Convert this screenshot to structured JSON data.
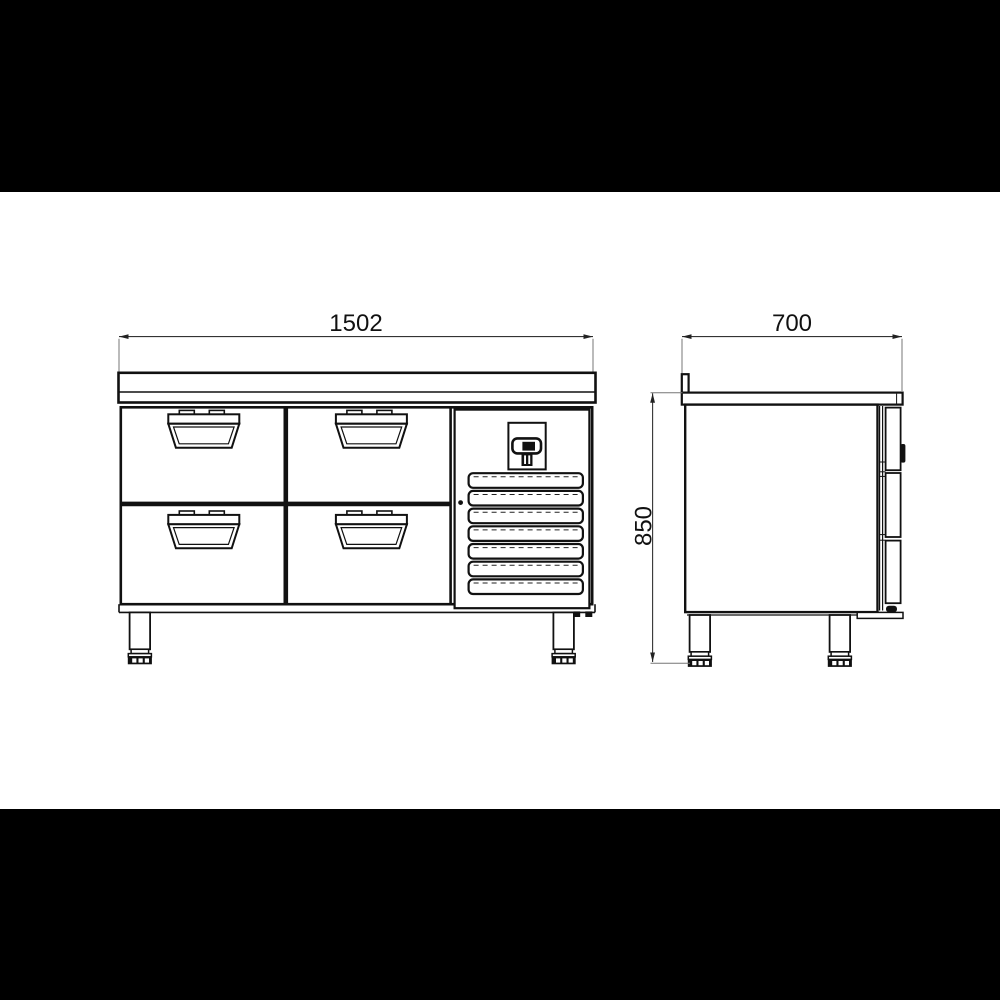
{
  "drawing": {
    "dimension_labels": {
      "front_width": "1502",
      "depth": "700",
      "height": "850"
    }
  }
}
